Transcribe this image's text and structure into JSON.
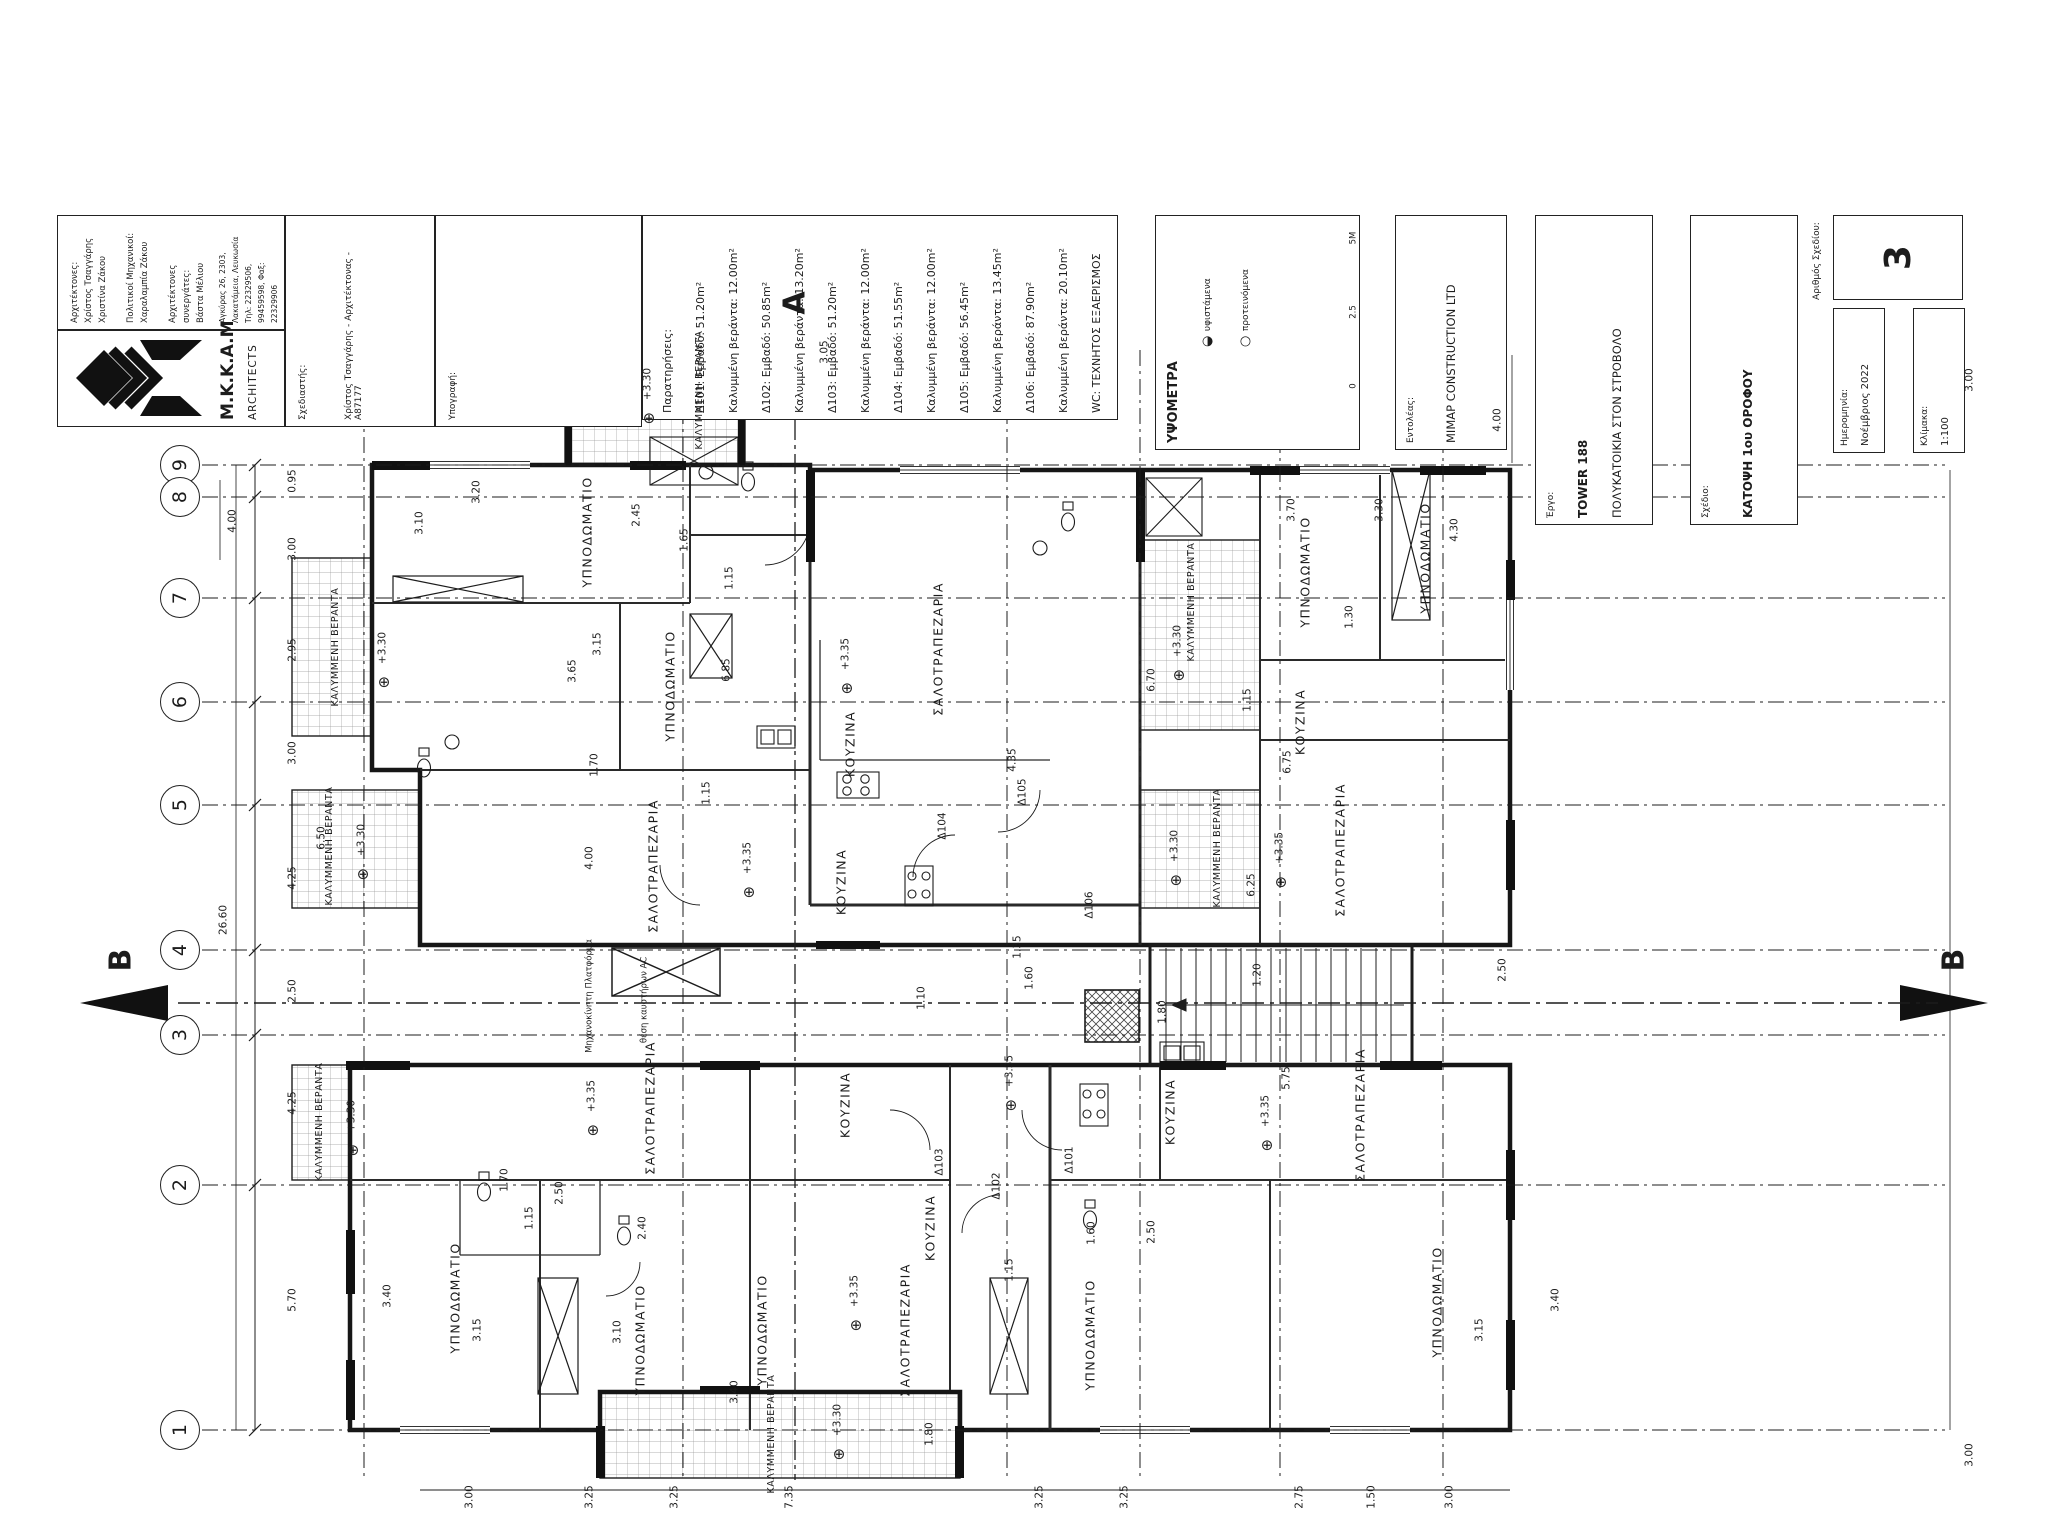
{
  "sheet": {
    "background": "#ffffff",
    "line_color": "#1c1c1c"
  },
  "title_strip": {
    "architects_box": {
      "name_lines": [
        "Αρχιτέκτονες:",
        "Χρίστος Τσαγγάρης",
        "Χριστίνα Ζάκου",
        "",
        "Πολιτικοί Μηχανικοί:",
        "Χαραλαμπία Ζάκου",
        "",
        "Αρχιτέκτονες συνεργάτες:",
        "Βάστα Μέλιου"
      ],
      "address_lines": [
        "Αγκύρας 26, 2303, Λακατάμεια, Λευκωσία",
        "Τηλ: 22329506, 99459598, Φαξ: 22329906",
        "Email: mkkaparch@cytanet.com.cy"
      ]
    },
    "logo_box": {
      "name": "M.K.K.A.M",
      "subtitle": "ARCHITECTS"
    },
    "designer_box": {
      "label": "Σχεδιαστής:",
      "value": "Χρίστος Τσαγγάρης - Αρχιτέκτονας - Α87177"
    },
    "signature_box": {
      "label": "Υπογραφή:"
    },
    "notes_box": {
      "title": "Παρατηρήσεις:",
      "entries": [
        {
          "tag": "Δ101:",
          "area": "Εμβαδό: 51.20m²",
          "veranda": "Καλυμμένη βεράντα: 12.00m²"
        },
        {
          "tag": "Δ102:",
          "area": "Εμβαδό: 50.85m²",
          "veranda": "Καλυμμένη βεράντα: 13.20m²"
        },
        {
          "tag": "Δ103:",
          "area": "Εμβαδό: 51.20m²",
          "veranda": "Καλυμμένη βεράντα: 12.00m²"
        },
        {
          "tag": "Δ104:",
          "area": "Εμβαδό: 51.55m²",
          "veranda": "Καλυμμένη βεράντα: 12.00m²"
        },
        {
          "tag": "Δ105:",
          "area": "Εμβαδό: 56.45m²",
          "veranda": "Καλυμμένη βεράντα: 13.45m²"
        },
        {
          "tag": "Δ106:",
          "area": "Εμβαδό: 87.90m²",
          "veranda": "Καλυμμένη βεράντα: 20.10m²"
        }
      ],
      "footnote": "WC: ΤΕΧΝΗΤΟΣ ΕΞΑΕΡΙΣΜΟΣ"
    },
    "levels_box": {
      "title": "ΥΨΟΜΕΤΡΑ",
      "legend": [
        {
          "symbol": "◐",
          "label": "υφιστάμενα"
        },
        {
          "symbol": "○",
          "label": "προτεινόμενα"
        }
      ],
      "scalebar_labels": [
        {
          "t": "5M",
          "y": 238
        },
        {
          "t": "2.5",
          "y": 312
        },
        {
          "t": "0",
          "y": 386
        }
      ]
    },
    "client_box": {
      "label": "Εντολέας:",
      "value": "MIMAP CONSTRUCTION LTD"
    },
    "project_box": {
      "label": "Έργο:",
      "value1": "TOWER 188",
      "value2": "ΠΟΛΥΚΑΤΟΙΚΙΑ ΣΤΟΝ ΣΤΡΟΒΟΛΟ"
    },
    "drawing_box": {
      "label": "Σχέδιο:",
      "value": "ΚΑΤΟΨΗ 1ου ΟΡΟΦΟΥ"
    },
    "number_box": {
      "label": "Αριθμός Σχεδίου:",
      "value": "3"
    },
    "date_box": {
      "label": "Ημερομηνία:",
      "value": "Νοέμβριος 2022"
    },
    "scale_box": {
      "label": "Κλίμακα:",
      "value": "1:100"
    }
  },
  "grid": {
    "bubble_x": 180,
    "bubbles": [
      {
        "n": "9",
        "y": 465
      },
      {
        "n": "8",
        "y": 497
      },
      {
        "n": "7",
        "y": 598
      },
      {
        "n": "6",
        "y": 702
      },
      {
        "n": "5",
        "y": 805
      },
      {
        "n": "4",
        "y": 950
      },
      {
        "n": "3",
        "y": 1035
      },
      {
        "n": "2",
        "y": 1185
      },
      {
        "n": "1",
        "y": 1430
      }
    ],
    "left_dim_x": 293,
    "left_dims": [
      {
        "t": "0.95",
        "y": 481
      },
      {
        "t": "3.00",
        "y": 549
      },
      {
        "t": "2.95",
        "y": 650
      },
      {
        "t": "3.00",
        "y": 753
      },
      {
        "t": "4.25",
        "y": 878
      },
      {
        "t": "2.50",
        "y": 991
      },
      {
        "t": "4.25",
        "y": 1103
      },
      {
        "t": "5.70",
        "y": 1300
      }
    ],
    "overall_dim": {
      "t": "26.60",
      "x": 224,
      "y": 920
    },
    "bottom_dim_y": 1497,
    "bottom_dims": [
      {
        "t": "3.00",
        "x": 470
      },
      {
        "t": "3.25",
        "x": 590
      },
      {
        "t": "3.25",
        "x": 675
      },
      {
        "t": "7.35",
        "x": 790
      },
      {
        "t": "3.25",
        "x": 1040
      },
      {
        "t": "3.25",
        "x": 1125
      },
      {
        "t": "2.75",
        "x": 1300
      },
      {
        "t": "1.50",
        "x": 1372
      },
      {
        "t": "3.00",
        "x": 1450
      }
    ],
    "right_dims": [
      {
        "t": "3.00",
        "x": 1970,
        "y": 380
      },
      {
        "t": "3.00",
        "x": 1970,
        "y": 1455
      }
    ]
  },
  "sections": {
    "a_top": {
      "t": "A",
      "x": 795,
      "y": 303
    },
    "b_left": {
      "t": "B",
      "x": 121,
      "y": 960
    },
    "b_right": {
      "t": "B",
      "x": 1954,
      "y": 960
    }
  },
  "plan": {
    "axes_x": [
      364,
      683,
      1007,
      1140,
      1280,
      1443
    ],
    "rooms": [
      {
        "t": "ΥΠΝΟΔΩΜΑΤΙΟ",
        "x": 587,
        "y": 532
      },
      {
        "t": "ΥΠΝΟΔΩΜΑΤΙΟ",
        "x": 670,
        "y": 686
      },
      {
        "t": "ΣΑΛΟΤΡΑΠΕΖΑΡΙΑ",
        "x": 938,
        "y": 649
      },
      {
        "t": "ΚΟΥΖΙΝΑ",
        "x": 850,
        "y": 744
      },
      {
        "t": "ΣΑΛΟΤΡΑΠΕΖΑΡΙΑ",
        "x": 653,
        "y": 866
      },
      {
        "t": "ΚΟΥΖΙΝΑ",
        "x": 841,
        "y": 882
      },
      {
        "t": "ΥΠΝΟΔΩΜΑΤΙΟ",
        "x": 1305,
        "y": 572
      },
      {
        "t": "ΥΠΝΟΔΩΜΑΤΙΟ",
        "x": 1425,
        "y": 558
      },
      {
        "t": "ΚΟΥΖΙΝΑ",
        "x": 1300,
        "y": 722
      },
      {
        "t": "ΣΑΛΟΤΡΑΠΕΖΑΡΙΑ",
        "x": 1340,
        "y": 850
      },
      {
        "t": "ΣΑΛΟΤΡΑΠΕΖΑΡΙΑ",
        "x": 650,
        "y": 1108
      },
      {
        "t": "ΚΟΥΖΙΝΑ",
        "x": 845,
        "y": 1105
      },
      {
        "t": "ΚΟΥΖΙΝΑ",
        "x": 1170,
        "y": 1112
      },
      {
        "t": "ΣΑΛΟΤΡΑΠΕΖΑΡΙΑ",
        "x": 1360,
        "y": 1115
      },
      {
        "t": "ΥΠΝΟΔΩΜΑΤΙΟ",
        "x": 455,
        "y": 1298
      },
      {
        "t": "ΥΠΝΟΔΩΜΑΤΙΟ",
        "x": 640,
        "y": 1340
      },
      {
        "t": "ΥΠΝΟΔΩΜΑΤΙΟ",
        "x": 762,
        "y": 1330
      },
      {
        "t": "ΣΑΛΟΤΡΑΠΕΖΑΡΙΑ",
        "x": 905,
        "y": 1330
      },
      {
        "t": "ΚΟΥΖΙΝΑ",
        "x": 930,
        "y": 1228
      },
      {
        "t": "ΥΠΝΟΔΩΜΑΤΙΟ",
        "x": 1090,
        "y": 1335
      },
      {
        "t": "ΥΠΝΟΔΩΜΑΤΙΟ",
        "x": 1437,
        "y": 1302
      }
    ],
    "veranda_labels": [
      {
        "t": "ΚΑΛΥΜΜΕΝΗ ΒΕΡΑΝΤΑ",
        "x": 700,
        "y": 390
      },
      {
        "t": "ΚΑΛΥΜΜΕΝΗ ΒΕΡΑΝΤΑ",
        "x": 336,
        "y": 647
      },
      {
        "t": "ΚΑΛΥΜΜΕΝΗ ΒΕΡΑΝΤΑ",
        "x": 330,
        "y": 846
      },
      {
        "t": "ΚΑΛΥΜΜΕΝΗ ΒΕΡΑΝΤΑ",
        "x": 320,
        "y": 1122
      },
      {
        "t": "ΚΑΛΥΜΜΕΝΗ ΒΕΡΑΝΤΑ",
        "x": 1192,
        "y": 602
      },
      {
        "t": "ΚΑΛΥΜΜΕΝΗ ΒΕΡΑΝΤΑ",
        "x": 1218,
        "y": 848
      },
      {
        "t": "ΚΑΛΥΜΜΕΝΗ ΒΕΡΑΝΤΑ",
        "x": 772,
        "y": 1434
      }
    ],
    "levels": [
      {
        "t": "+3.30",
        "x": 648,
        "y": 384
      },
      {
        "t": "+3.35",
        "x": 846,
        "y": 654
      },
      {
        "t": "+3.35",
        "x": 748,
        "y": 858
      },
      {
        "t": "+3.30",
        "x": 383,
        "y": 648
      },
      {
        "t": "+3.30",
        "x": 362,
        "y": 840
      },
      {
        "t": "+3.30",
        "x": 352,
        "y": 1116
      },
      {
        "t": "+3.30",
        "x": 1178,
        "y": 641
      },
      {
        "t": "+3.30",
        "x": 1175,
        "y": 846
      },
      {
        "t": "+3.35",
        "x": 1280,
        "y": 848
      },
      {
        "t": "+3.35",
        "x": 592,
        "y": 1096
      },
      {
        "t": "+3.35",
        "x": 1010,
        "y": 1071
      },
      {
        "t": "+3.35",
        "x": 1266,
        "y": 1111
      },
      {
        "t": "+3.35",
        "x": 855,
        "y": 1291
      },
      {
        "t": "+3.30",
        "x": 838,
        "y": 1420
      }
    ],
    "tags": [
      {
        "t": "Δ101",
        "x": 1070,
        "y": 1160
      },
      {
        "t": "Δ102",
        "x": 997,
        "y": 1186
      },
      {
        "t": "Δ103",
        "x": 940,
        "y": 1162
      },
      {
        "t": "Δ104",
        "x": 943,
        "y": 826
      },
      {
        "t": "Δ105",
        "x": 1023,
        "y": 792
      },
      {
        "t": "Δ106",
        "x": 1090,
        "y": 905
      }
    ],
    "dims": [
      {
        "t": "3.10",
        "x": 420,
        "y": 523
      },
      {
        "t": "3.20",
        "x": 477,
        "y": 492
      },
      {
        "t": "2.45",
        "x": 637,
        "y": 515
      },
      {
        "t": "1.65",
        "x": 685,
        "y": 540
      },
      {
        "t": "1.15",
        "x": 730,
        "y": 578
      },
      {
        "t": "3.15",
        "x": 598,
        "y": 644
      },
      {
        "t": "3.65",
        "x": 573,
        "y": 671
      },
      {
        "t": "6.85",
        "x": 727,
        "y": 670
      },
      {
        "t": "4.35",
        "x": 1013,
        "y": 760
      },
      {
        "t": "1.70",
        "x": 595,
        "y": 765
      },
      {
        "t": "1.15",
        "x": 707,
        "y": 793
      },
      {
        "t": "4.00",
        "x": 590,
        "y": 858
      },
      {
        "t": "3.70",
        "x": 1292,
        "y": 510
      },
      {
        "t": "3.30",
        "x": 1380,
        "y": 510
      },
      {
        "t": "4.30",
        "x": 1455,
        "y": 530
      },
      {
        "t": "1.30",
        "x": 1350,
        "y": 617
      },
      {
        "t": "1.15",
        "x": 1248,
        "y": 700
      },
      {
        "t": "6.75",
        "x": 1288,
        "y": 762
      },
      {
        "t": "6.70",
        "x": 1152,
        "y": 680
      },
      {
        "t": "6.50",
        "x": 322,
        "y": 838
      },
      {
        "t": "6.25",
        "x": 1252,
        "y": 885
      },
      {
        "t": "1.35",
        "x": 1018,
        "y": 947
      },
      {
        "t": "1.60",
        "x": 1030,
        "y": 978
      },
      {
        "t": "1.10",
        "x": 922,
        "y": 998
      },
      {
        "t": "1.20",
        "x": 1258,
        "y": 975
      },
      {
        "t": "1.80",
        "x": 1163,
        "y": 1012
      },
      {
        "t": "2.50",
        "x": 1503,
        "y": 970
      },
      {
        "t": "5.75",
        "x": 1287,
        "y": 1078
      },
      {
        "t": "2.50",
        "x": 560,
        "y": 1193
      },
      {
        "t": "1.70",
        "x": 505,
        "y": 1180
      },
      {
        "t": "2.40",
        "x": 643,
        "y": 1228
      },
      {
        "t": "1.15",
        "x": 530,
        "y": 1218
      },
      {
        "t": "3.40",
        "x": 388,
        "y": 1296
      },
      {
        "t": "3.15",
        "x": 478,
        "y": 1330
      },
      {
        "t": "3.10",
        "x": 618,
        "y": 1332
      },
      {
        "t": "3.40",
        "x": 735,
        "y": 1392
      },
      {
        "t": "1.15",
        "x": 1010,
        "y": 1270
      },
      {
        "t": "1.60",
        "x": 1092,
        "y": 1233
      },
      {
        "t": "2.50",
        "x": 1152,
        "y": 1232
      },
      {
        "t": "3.15",
        "x": 1480,
        "y": 1330
      },
      {
        "t": "3.40",
        "x": 1556,
        "y": 1300
      },
      {
        "t": "1.80",
        "x": 930,
        "y": 1434
      },
      {
        "t": "4.00",
        "x": 233,
        "y": 521
      },
      {
        "t": "4.00",
        "x": 1498,
        "y": 420
      },
      {
        "t": "3.05",
        "x": 825,
        "y": 352
      }
    ],
    "small_texts": [
      {
        "t": "Μηχανοκίνητη Πλατφόρμα",
        "x": 590,
        "y": 996
      },
      {
        "t": "θέση καυστήρων AC",
        "x": 645,
        "y": 1000
      }
    ]
  }
}
